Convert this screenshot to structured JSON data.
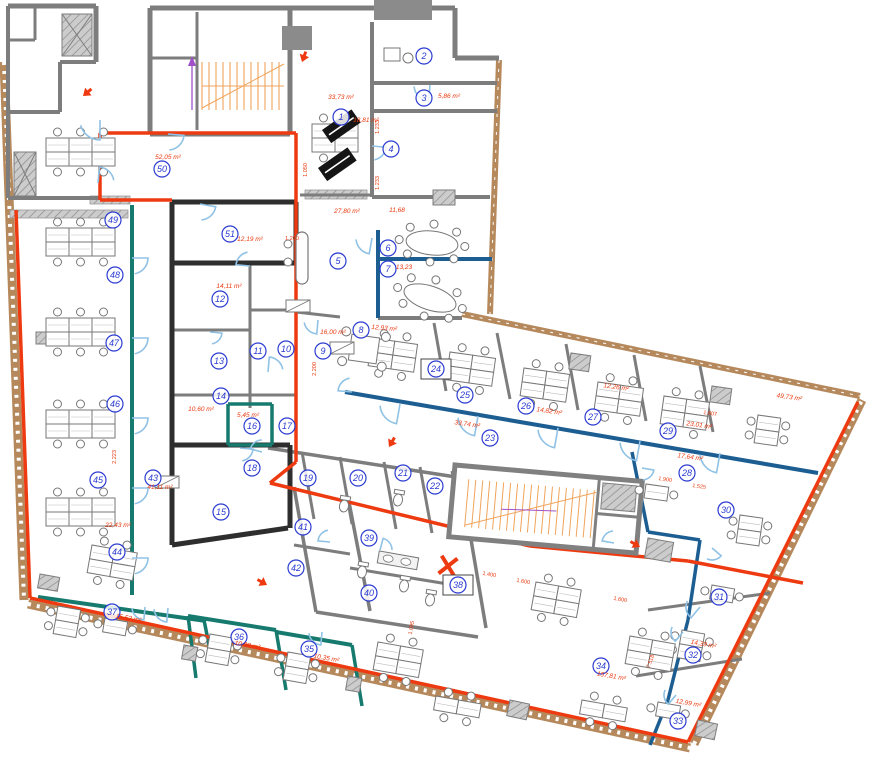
{
  "plan": {
    "type": "architectural-floor-plan",
    "unit": "m²",
    "colors": {
      "wall_red": "#ee3a10",
      "wall_teal": "#177a6e",
      "wall_blue": "#1d5e92",
      "wall_black": "#2e2e2e",
      "wall_gray": "#7d7d7d",
      "exterior_brown": "#b5895c",
      "stair_orange": "#f0a45c",
      "door_blue": "#8fc2e5",
      "badge_blue": "#2b3bd0",
      "area_red": "#e8380d",
      "marker_purple": "#a050c8",
      "furniture_gray": "#777777"
    },
    "boxed_rooms": [
      "24",
      "38"
    ],
    "rooms": [
      {
        "n": "1",
        "x": 341,
        "y": 117,
        "area": "33,73 m²",
        "ax": 341,
        "ay": 99,
        "arot": 0
      },
      {
        "n": "2",
        "x": 424,
        "y": 56
      },
      {
        "n": "3",
        "x": 424,
        "y": 98,
        "area": "5,86 m²",
        "ax": 449,
        "ay": 98,
        "arot": 0
      },
      {
        "n": "4",
        "x": 391,
        "y": 149,
        "area": "18,81 m²",
        "ax": 366,
        "ay": 122,
        "arot": 0
      },
      {
        "n": "5",
        "x": 338,
        "y": 261,
        "area": "27,80 m²",
        "ax": 347,
        "ay": 213,
        "arot": 0
      },
      {
        "n": "6",
        "x": 388,
        "y": 248,
        "area": "11,68",
        "ax": 397,
        "ay": 212,
        "arot": 0
      },
      {
        "n": "7",
        "x": 388,
        "y": 269,
        "area": "13,23",
        "ax": 404,
        "ay": 269,
        "arot": 0
      },
      {
        "n": "8",
        "x": 361,
        "y": 330,
        "area": "12,93 m²",
        "ax": 384,
        "ay": 330,
        "arot": 5
      },
      {
        "n": "9",
        "x": 323,
        "y": 351,
        "area": "16,00 m²",
        "ax": 333,
        "ay": 334,
        "arot": 0
      },
      {
        "n": "10",
        "x": 286,
        "y": 349
      },
      {
        "n": "11",
        "x": 258,
        "y": 351
      },
      {
        "n": "12",
        "x": 220,
        "y": 299,
        "area": "14,11 m²",
        "ax": 229,
        "ay": 288,
        "arot": 0
      },
      {
        "n": "13",
        "x": 219,
        "y": 361
      },
      {
        "n": "14",
        "x": 221,
        "y": 396
      },
      {
        "n": "15",
        "x": 221,
        "y": 512
      },
      {
        "n": "16",
        "x": 252,
        "y": 426,
        "area": "5,45 m²",
        "ax": 248,
        "ay": 417,
        "arot": 0
      },
      {
        "n": "17",
        "x": 287,
        "y": 426
      },
      {
        "n": "18",
        "x": 252,
        "y": 468
      },
      {
        "n": "19",
        "x": 308,
        "y": 478
      },
      {
        "n": "20",
        "x": 358,
        "y": 478
      },
      {
        "n": "21",
        "x": 403,
        "y": 473
      },
      {
        "n": "22",
        "x": 435,
        "y": 486
      },
      {
        "n": "23",
        "x": 490,
        "y": 438,
        "area": "33,74 m²",
        "ax": 467,
        "ay": 426,
        "arot": 8
      },
      {
        "n": "24",
        "x": 436,
        "y": 369
      },
      {
        "n": "25",
        "x": 465,
        "y": 395
      },
      {
        "n": "26",
        "x": 526,
        "y": 406,
        "area": "14,82 m²",
        "ax": 549,
        "ay": 413,
        "arot": 8
      },
      {
        "n": "27",
        "x": 593,
        "y": 417,
        "area": "12,26 m²",
        "ax": 616,
        "ay": 389,
        "arot": 8
      },
      {
        "n": "28",
        "x": 687,
        "y": 473,
        "area": "17,64 m²",
        "ax": 690,
        "ay": 459,
        "arot": 8
      },
      {
        "n": "29",
        "x": 668,
        "y": 431,
        "area": "23,01 m²",
        "ax": 699,
        "ay": 427,
        "arot": 8
      },
      {
        "n": "30",
        "x": 726,
        "y": 510
      },
      {
        "n": "31",
        "x": 719,
        "y": 597
      },
      {
        "n": "32",
        "x": 693,
        "y": 655,
        "area": "14,39 m²",
        "ax": 703,
        "ay": 646,
        "arot": 10
      },
      {
        "n": "33",
        "x": 678,
        "y": 721,
        "area": "12,99 m²",
        "ax": 688,
        "ay": 705,
        "arot": 10
      },
      {
        "n": "34",
        "x": 601,
        "y": 666,
        "area": "157,81 m²",
        "ax": 611,
        "ay": 678,
        "arot": 10
      },
      {
        "n": "35",
        "x": 309,
        "y": 649,
        "area": "10,35 m²",
        "ax": 326,
        "ay": 660,
        "arot": 10
      },
      {
        "n": "36",
        "x": 239,
        "y": 637,
        "area": "10,28 m²",
        "ax": 247,
        "ay": 647,
        "arot": 10
      },
      {
        "n": "37",
        "x": 112,
        "y": 612,
        "area": "15,52 m²",
        "ax": 128,
        "ay": 620,
        "arot": 10
      },
      {
        "n": "38",
        "x": 458,
        "y": 585
      },
      {
        "n": "39",
        "x": 369,
        "y": 538
      },
      {
        "n": "40",
        "x": 369,
        "y": 593
      },
      {
        "n": "41",
        "x": 303,
        "y": 527
      },
      {
        "n": "42",
        "x": 296,
        "y": 568
      },
      {
        "n": "43",
        "x": 153,
        "y": 478,
        "area": "41,11 m²",
        "ax": 160,
        "ay": 489,
        "arot": 0
      },
      {
        "n": "44",
        "x": 117,
        "y": 552,
        "area": "22,43 m²",
        "ax": 118,
        "ay": 527,
        "arot": 0
      },
      {
        "n": "45",
        "x": 98,
        "y": 480
      },
      {
        "n": "46",
        "x": 115,
        "y": 404
      },
      {
        "n": "47",
        "x": 114,
        "y": 343
      },
      {
        "n": "48",
        "x": 115,
        "y": 275
      },
      {
        "n": "49",
        "x": 113,
        "y": 220
      },
      {
        "n": "50",
        "x": 162,
        "y": 169,
        "area": "52,05 m²",
        "ax": 168,
        "ay": 159,
        "arot": 0
      },
      {
        "n": "51",
        "x": 230,
        "y": 234,
        "area": "12,19 m²",
        "ax": 250,
        "ay": 241,
        "arot": 0
      }
    ],
    "open_areas": [
      {
        "area": "49,73 m²",
        "x": 789,
        "y": 399,
        "rot": 8
      },
      {
        "area": "10,60 m²",
        "x": 201,
        "y": 411,
        "rot": 0
      }
    ],
    "dimensions": [
      {
        "t": "1.050",
        "x": 307,
        "y": 170,
        "rot": -90
      },
      {
        "t": "1.233",
        "x": 379,
        "y": 127,
        "rot": -90
      },
      {
        "t": "1.233",
        "x": 379,
        "y": 183,
        "rot": -90
      },
      {
        "t": "1.200",
        "x": 292,
        "y": 240,
        "rot": 0
      },
      {
        "t": "2.200",
        "x": 316,
        "y": 369,
        "rot": -90
      },
      {
        "t": "2.223",
        "x": 116,
        "y": 457,
        "rot": -90
      },
      {
        "t": "1.400",
        "x": 489,
        "y": 576,
        "rot": 10
      },
      {
        "t": "1.600",
        "x": 523,
        "y": 583,
        "rot": 10
      },
      {
        "t": "1.600",
        "x": 620,
        "y": 601,
        "rot": 10
      },
      {
        "t": "1.900",
        "x": 665,
        "y": 481,
        "rot": 8
      },
      {
        "t": "1.525",
        "x": 699,
        "y": 488,
        "rot": 8
      },
      {
        "t": "1.607",
        "x": 710,
        "y": 415,
        "rot": 8
      },
      {
        "t": "1.095",
        "x": 413,
        "y": 628,
        "rot": -80
      },
      {
        "t": "7.518",
        "x": 652,
        "y": 662,
        "rot": -70
      }
    ],
    "fire_markers": [
      {
        "x": 83,
        "y": 96,
        "rot": 140
      },
      {
        "x": 302,
        "y": 62,
        "rot": 110
      },
      {
        "x": 389,
        "y": 447,
        "rot": 120
      },
      {
        "x": 267,
        "y": 585,
        "rot": 30
      },
      {
        "x": 640,
        "y": 547,
        "rot": 30
      }
    ],
    "x_marker": {
      "x": 448,
      "y": 566
    }
  }
}
